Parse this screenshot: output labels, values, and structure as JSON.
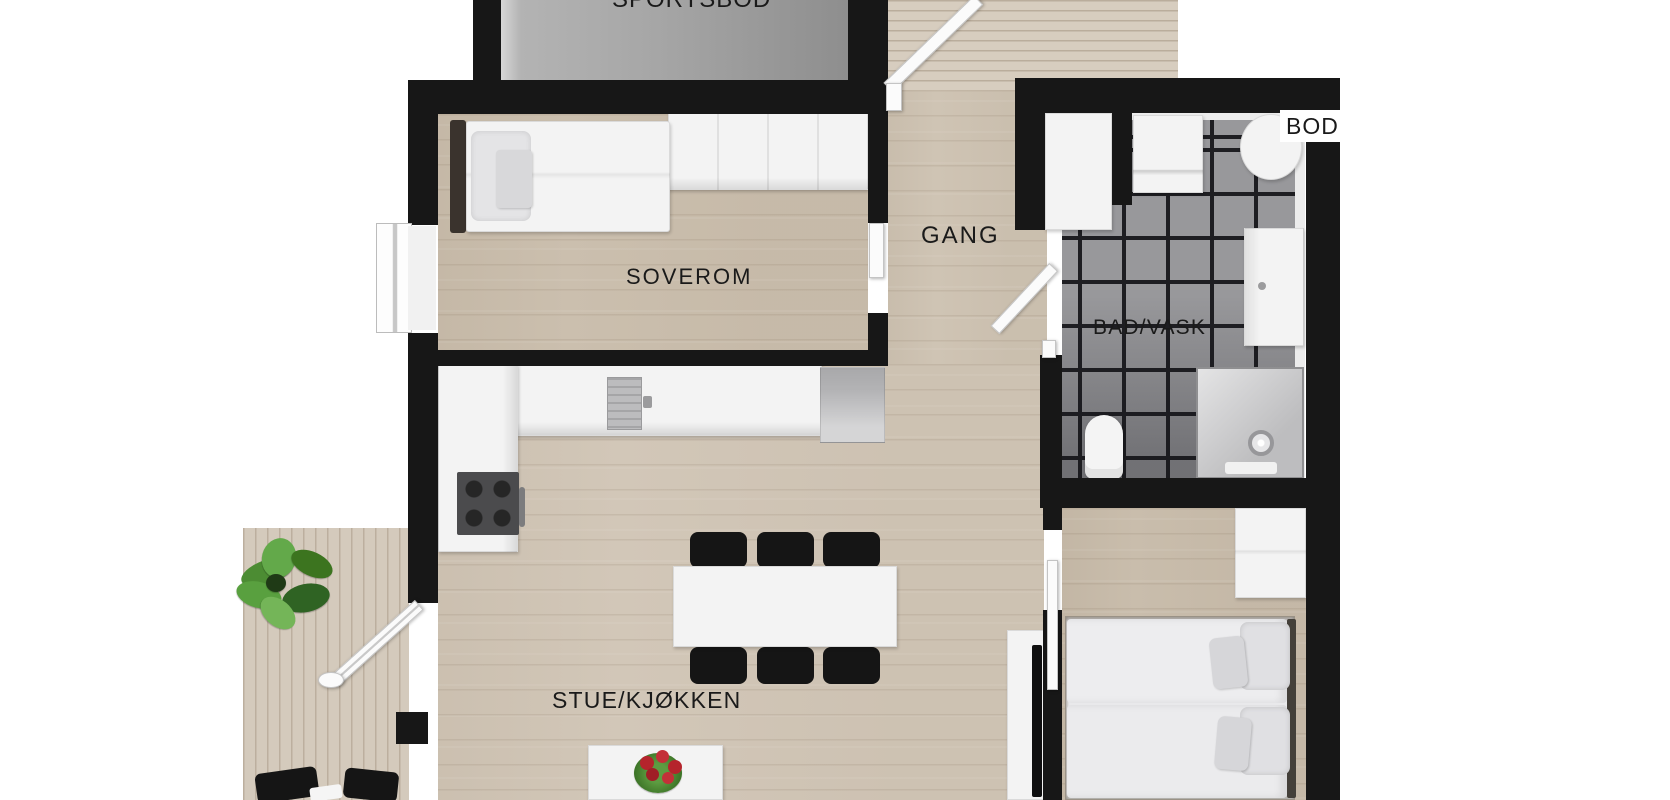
{
  "rooms": {
    "sportsbod": {
      "label": "SPORTSBOD"
    },
    "soverom": {
      "label": "SOVEROM"
    },
    "gang": {
      "label": "GANG"
    },
    "bad_vask": {
      "label": "BAD/VASK"
    },
    "bod": {
      "label": "BOD"
    },
    "stue_kjokken": {
      "label": "STUE/KJØKKEN"
    }
  },
  "colors": {
    "wall": "#171717",
    "wood_floor": "#d2c7b8",
    "soverom_floor": "#cbbfae",
    "bedroom_floor": "#c9bdac",
    "deck": "#d7cdbf",
    "balcony_deck": "#d4cabc",
    "sportsbod_floor": "#a4a4a4",
    "tile": "#98989b",
    "grout": "#1e1e22",
    "white_furniture": "#f3f3f3",
    "black_furniture": "#151515",
    "label_text": "#1a1a1a",
    "plant_green": "#4c8c33",
    "flower_red": "#b5242c"
  }
}
